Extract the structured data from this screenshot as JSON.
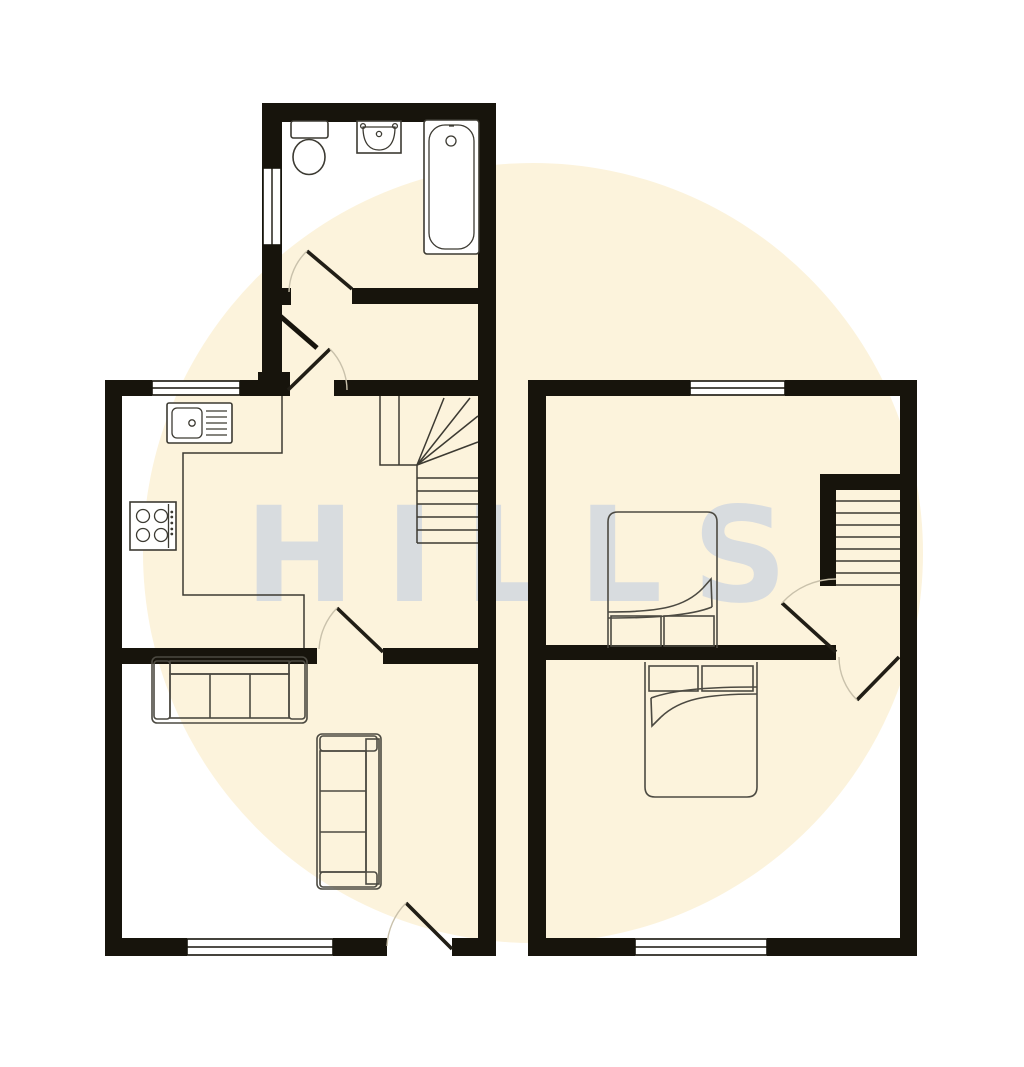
{
  "watermark": {
    "text": "HILLS"
  },
  "palette": {
    "background": "#ffffff",
    "halo": "#fcf3dc",
    "wall": "#17140c",
    "line": "#3c3a32",
    "furniture": "#4c4a42",
    "door": "#211e16",
    "arc": "#c9c1ab",
    "watermark": "#b9c8e2"
  },
  "plan": {
    "type": "floorplan",
    "floors": [
      {
        "name": "ground-floor",
        "rooms": [
          {
            "name": "bathroom",
            "fixtures": [
              "toilet",
              "basin",
              "bathtub"
            ],
            "windows": 1
          },
          {
            "name": "kitchen",
            "fixtures": [
              "sink-drainer",
              "hob",
              "worktop"
            ],
            "windows": 1
          },
          {
            "name": "living-room",
            "fixtures": [
              "three-seat-sofa",
              "three-seat-sofa"
            ],
            "windows": 1
          },
          {
            "name": "hall-stairs",
            "fixtures": [
              "winder-staircase"
            ]
          }
        ]
      },
      {
        "name": "first-floor",
        "rooms": [
          {
            "name": "bedroom-front",
            "fixtures": [
              "double-bed"
            ],
            "windows": 1
          },
          {
            "name": "bedroom-back",
            "fixtures": [
              "double-bed"
            ],
            "windows": 1
          },
          {
            "name": "landing",
            "fixtures": [
              "staircase"
            ]
          }
        ]
      }
    ]
  }
}
